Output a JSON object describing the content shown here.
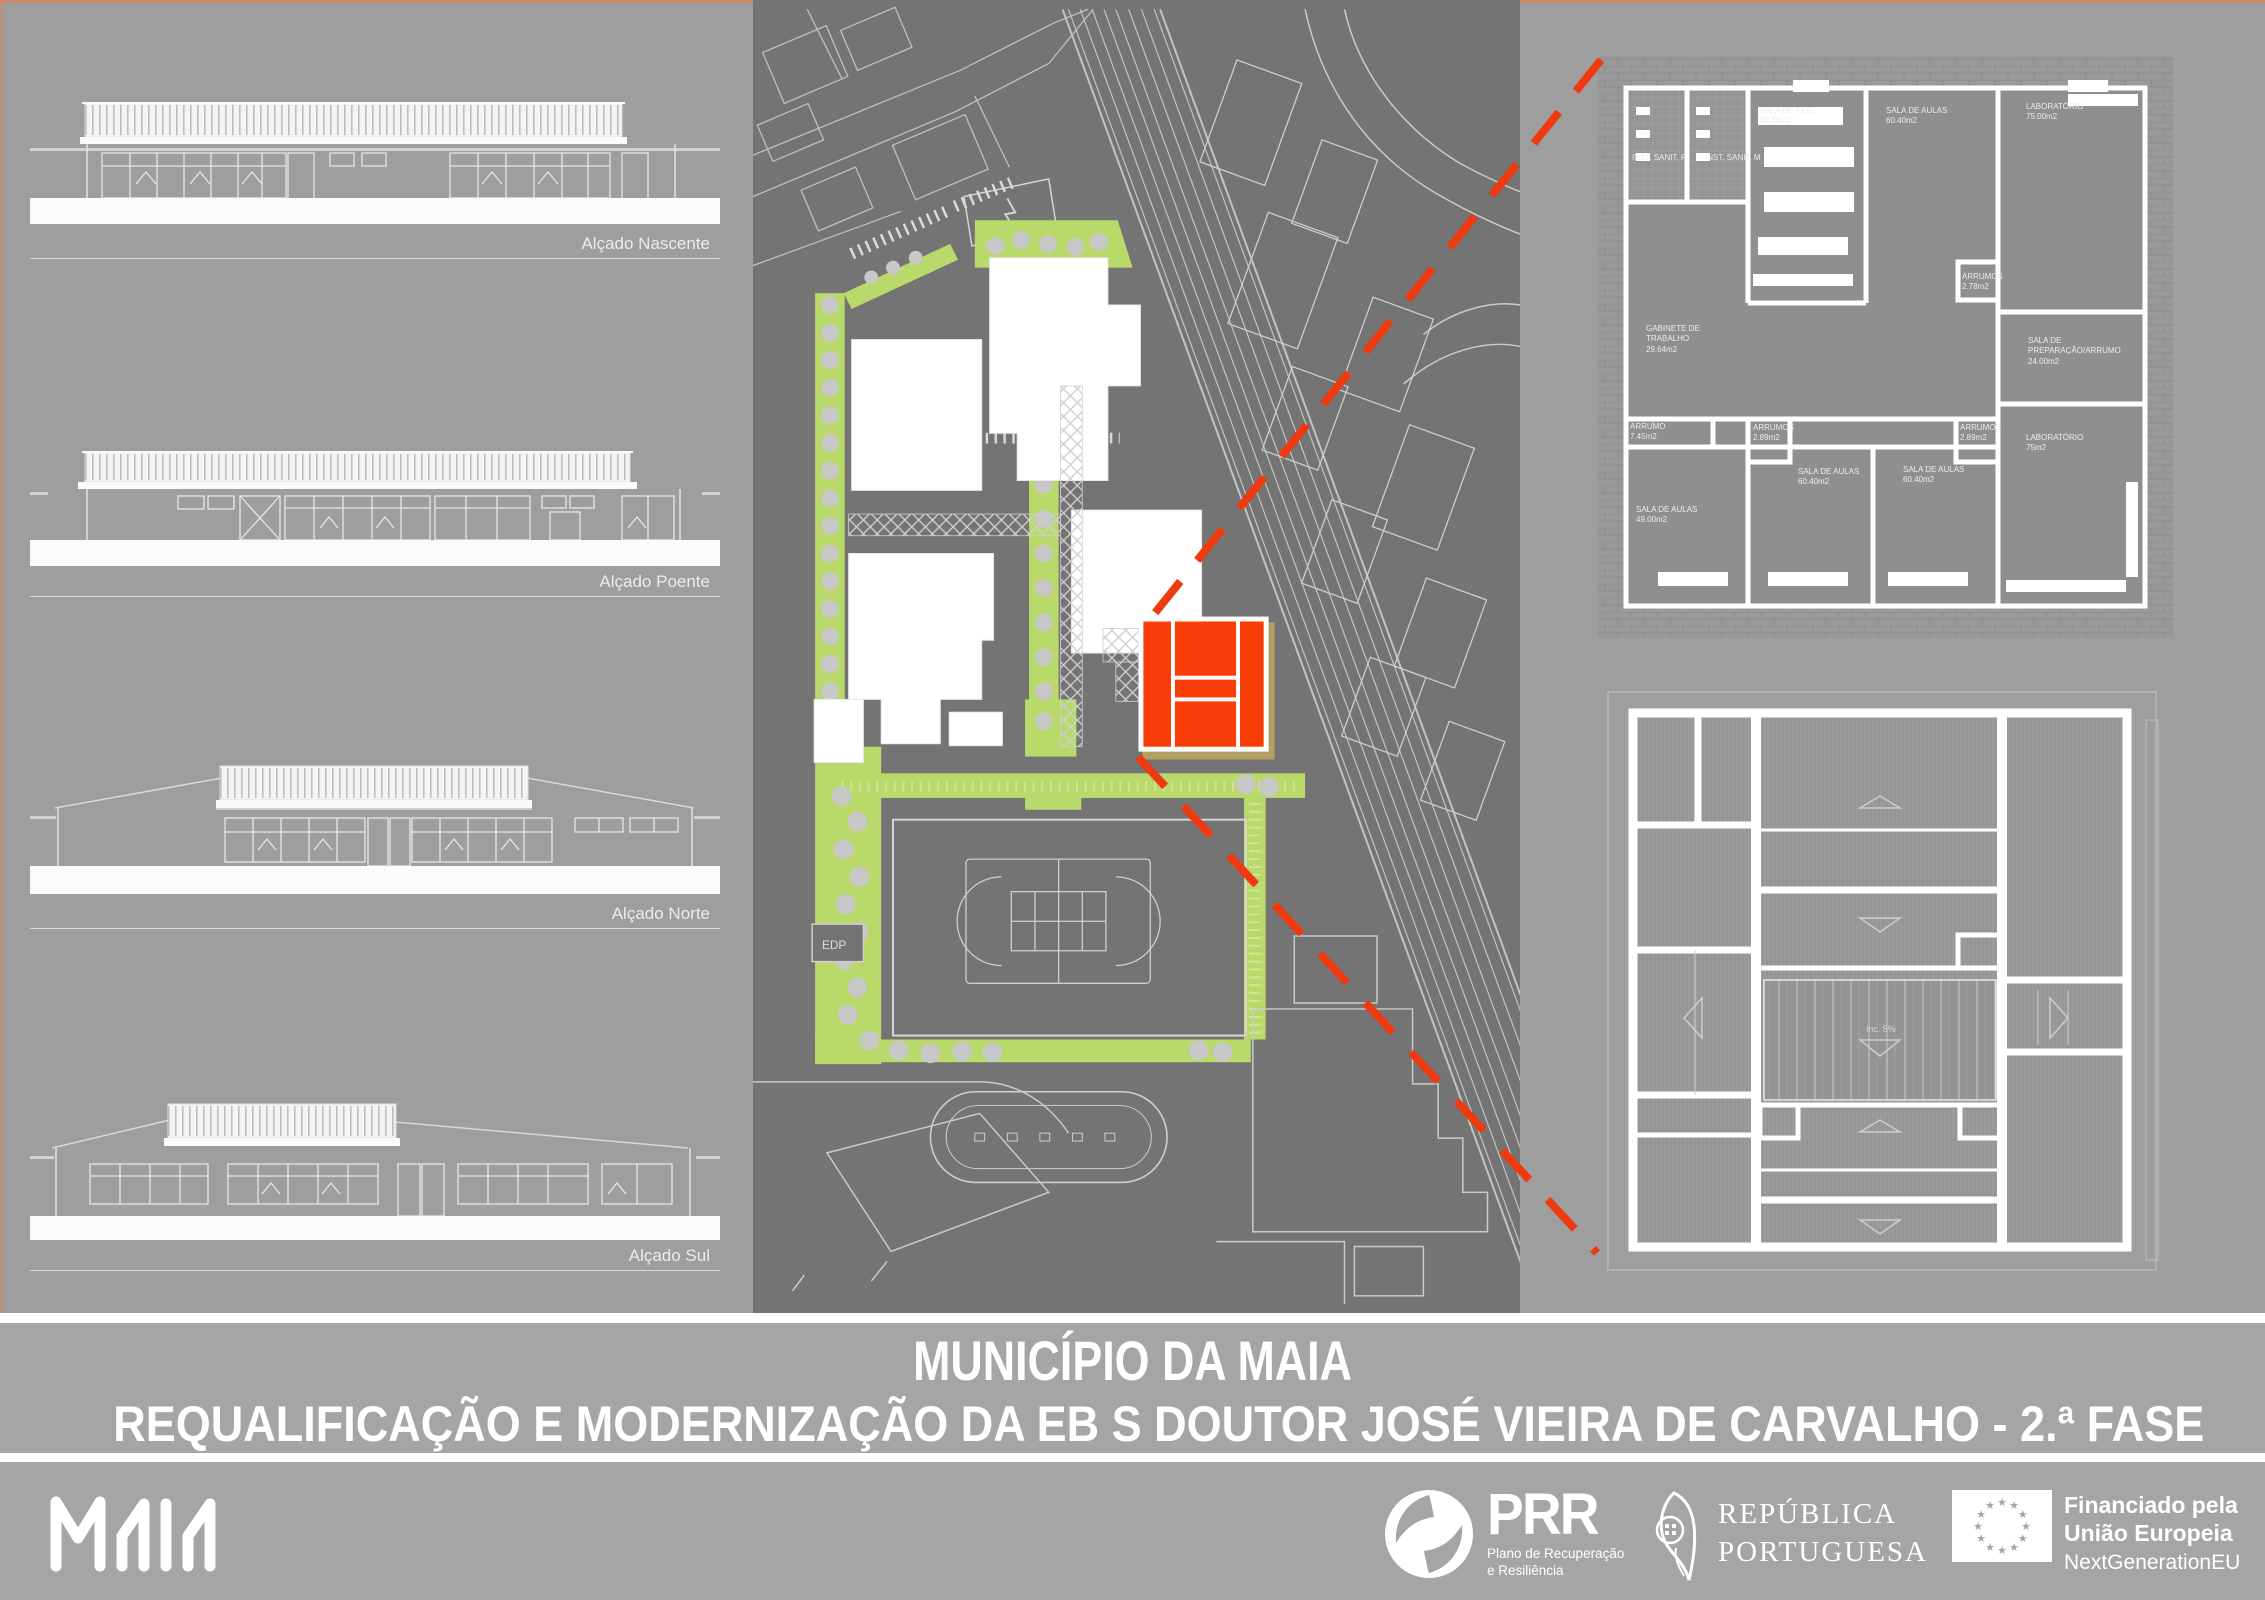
{
  "board": {
    "title": "MUNICÍPIO DA MAIA",
    "subtitle": "REQUALIFICAÇÃO E MODERNIZAÇÃO DA EB S DOUTOR JOSÉ VIEIRA DE CARVALHO - 2.ª FASE"
  },
  "elevations": {
    "items": [
      {
        "label": "Alçado Nascente"
      },
      {
        "label": "Alçado Poente"
      },
      {
        "label": "Alçado Norte"
      },
      {
        "label": "Alçado Sul"
      }
    ]
  },
  "site_plan": {
    "edp_label": "EDP"
  },
  "floor_plan": {
    "rooms": [
      {
        "name": "INST. SANIT. F",
        "area": ""
      },
      {
        "name": "INST. SANIT. M",
        "area": ""
      },
      {
        "name": "SALA DE T.I.C.",
        "area": "60.38m2"
      },
      {
        "name": "SALA DE AULAS",
        "area": "60.40m2"
      },
      {
        "name": "LABORATÓRIO",
        "area": "75.00m2"
      },
      {
        "name": "ARRUMOS",
        "area": "2.78m2"
      },
      {
        "name": "GABINETE DE TRABALHO",
        "area": "29.64m2"
      },
      {
        "name": "SALA DE PREPARAÇÃO/ARRUMO",
        "area": "24.00m2"
      },
      {
        "name": "ARRUMO",
        "area": "7.45m2"
      },
      {
        "name": "ARRUMOS",
        "area": "2.89m2"
      },
      {
        "name": "SALA DE AULAS",
        "area": "60.40m2"
      },
      {
        "name": "SALA DE AULAS",
        "area": "60.40m2"
      },
      {
        "name": "ARRUMOS",
        "area": "2.89m2"
      },
      {
        "name": "LABORATÓRIO",
        "area": "75m2"
      },
      {
        "name": "SALA DE AULAS",
        "area": "49.00m2"
      }
    ]
  },
  "roof_plan": {
    "slope_label": "inc. 5%"
  },
  "footer": {
    "maia_logo_alt": "MAIA",
    "prr": {
      "name": "PRR",
      "tagline1": "Plano de Recuperação",
      "tagline2": "e Resiliência"
    },
    "republic": {
      "line1": "REPÚBLICA",
      "line2": "PORTUGUESA"
    },
    "eu": {
      "line1": "Financiado pela",
      "line2": "União Europeia",
      "line3": "NextGenerationEU"
    }
  },
  "colors": {
    "highlight_orange": "#f93d08",
    "landscape_green": "#b9d96a",
    "tan_border": "#b3a164",
    "panel_dark": "#747474",
    "accent_dash": "#ee3a0e"
  }
}
